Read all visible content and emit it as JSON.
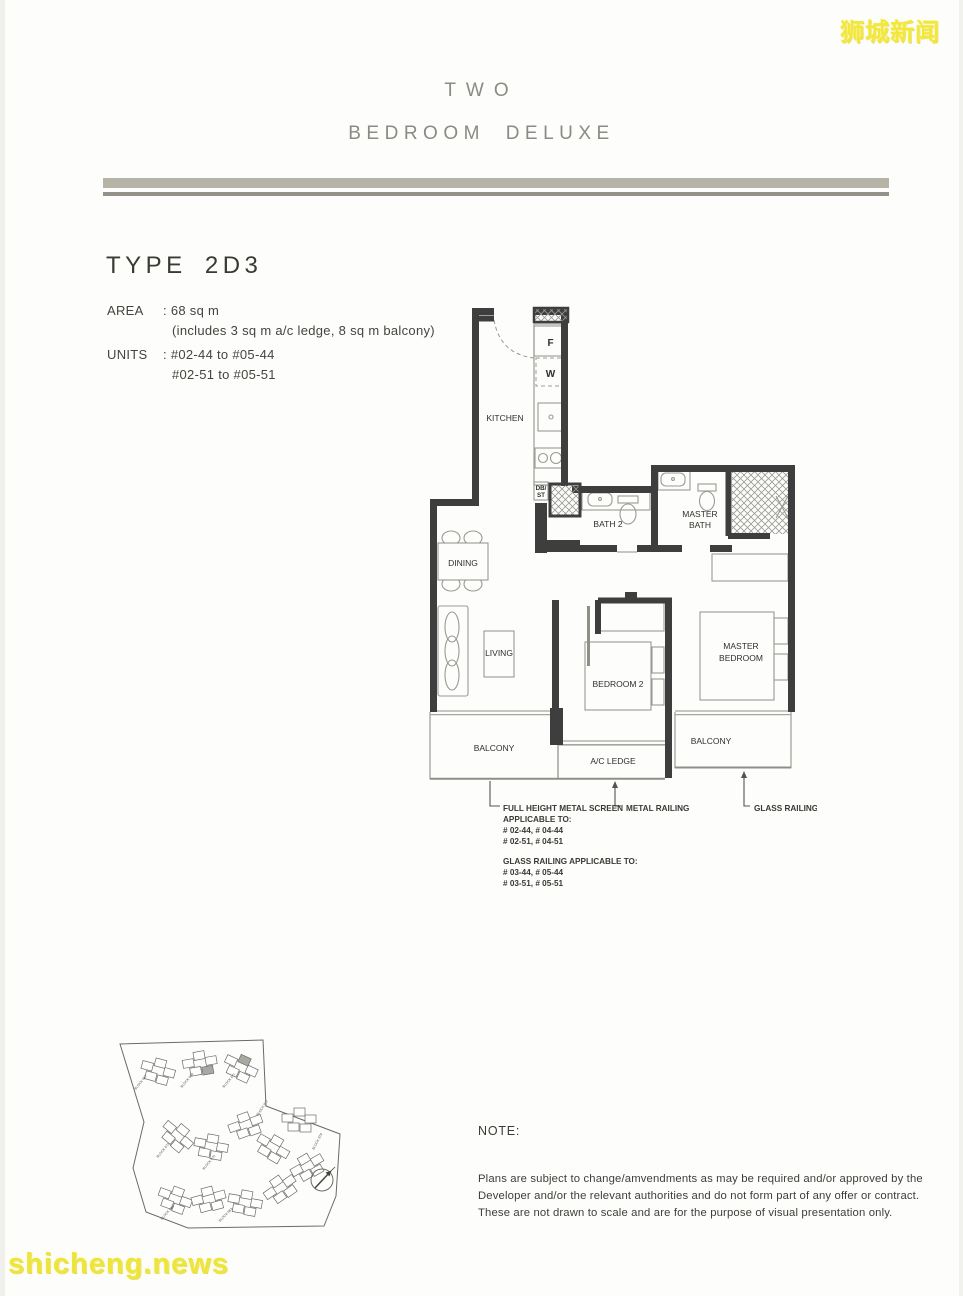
{
  "watermarks": {
    "top_right": "狮城新闻",
    "bottom_left": "shicheng.news"
  },
  "header": {
    "title_line1": "TWO",
    "title_line2": "BEDROOM DELUXE"
  },
  "unit_info": {
    "type": "TYPE 2D3",
    "area_label": "AREA",
    "area_value": ": 68 sq m",
    "area_note": "(includes 3 sq m a/c ledge, 8 sq m balcony)",
    "units_label": "UNITS",
    "units_line1": ": #02-44 to #05-44",
    "units_line2": "#02-51 to #05-51"
  },
  "floor_plan": {
    "rooms": {
      "kitchen": "KITCHEN",
      "bath2": "BATH 2",
      "master_bath_line1": "MASTER",
      "master_bath_line2": "BATH",
      "dining": "DINING",
      "living": "LIVING",
      "bedroom2": "BEDROOM 2",
      "master_bedroom_line1": "MASTER",
      "master_bedroom_line2": "BEDROOM",
      "balcony_left": "BALCONY",
      "ac_ledge": "A/C LEDGE",
      "balcony_right": "BALCONY"
    },
    "fixtures": {
      "fridge": "F",
      "washer": "W",
      "db_line1": "DB/",
      "db_line2": "ST"
    },
    "callouts": {
      "full_height_screen": [
        "FULL HEIGHT METAL SCREEN",
        "APPLICABLE TO:",
        "# 02-44, # 04-44",
        "# 02-51, # 04-51"
      ],
      "glass_railing_note": [
        "GLASS RAILING APPLICABLE TO:",
        "# 03-44, # 05-44",
        "# 03-51, # 05-51"
      ],
      "metal_railing": "METAL RAILING",
      "glass_railing": "GLASS RAILING"
    }
  },
  "site_plan": {
    "block_labels": [
      "BLOCK 967",
      "BLOCK 969",
      "BLOCK 971",
      "BLOCK 973",
      "BLOCK 975",
      "BLOCK 977",
      "BLOCK 979",
      "BLOCK 981",
      "BLOCK 983"
    ]
  },
  "note": {
    "label": "NOTE:",
    "lines": [
      "Plans are subject to change/amvendments as may be required and/or approved by the",
      "Developer and/or the relevant authorities and do not form part of any offer or contract.",
      "These are not drawn to scale and are for the purpose of visual presentation only."
    ]
  }
}
